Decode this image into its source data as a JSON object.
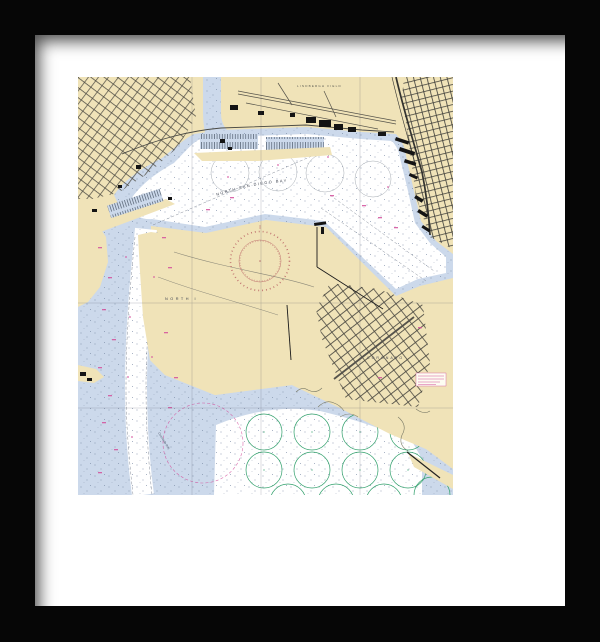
{
  "product": {
    "title": "Framed nautical chart print of North San Diego Bay",
    "frame_color": "#060606",
    "mat_color": "#ffffff"
  },
  "chart": {
    "labels": {
      "bay": "NORTH SAN DIEGO BAY",
      "north_island": "NORTH I",
      "coronado": "CORONADO",
      "airport": "LINDBERGH FIELD",
      "anchorage": "Coronado Rds"
    },
    "colors": {
      "land": "#f0e3b8",
      "shallow_water": "#ccd9eb",
      "deep_water": "#ffffff",
      "anchorage_green": "#2f9f6a",
      "nav_magenta": "#d4509c",
      "compass_rose": "#c0736f",
      "streets": "#44443e",
      "soundings": "#6d7f9b"
    }
  }
}
